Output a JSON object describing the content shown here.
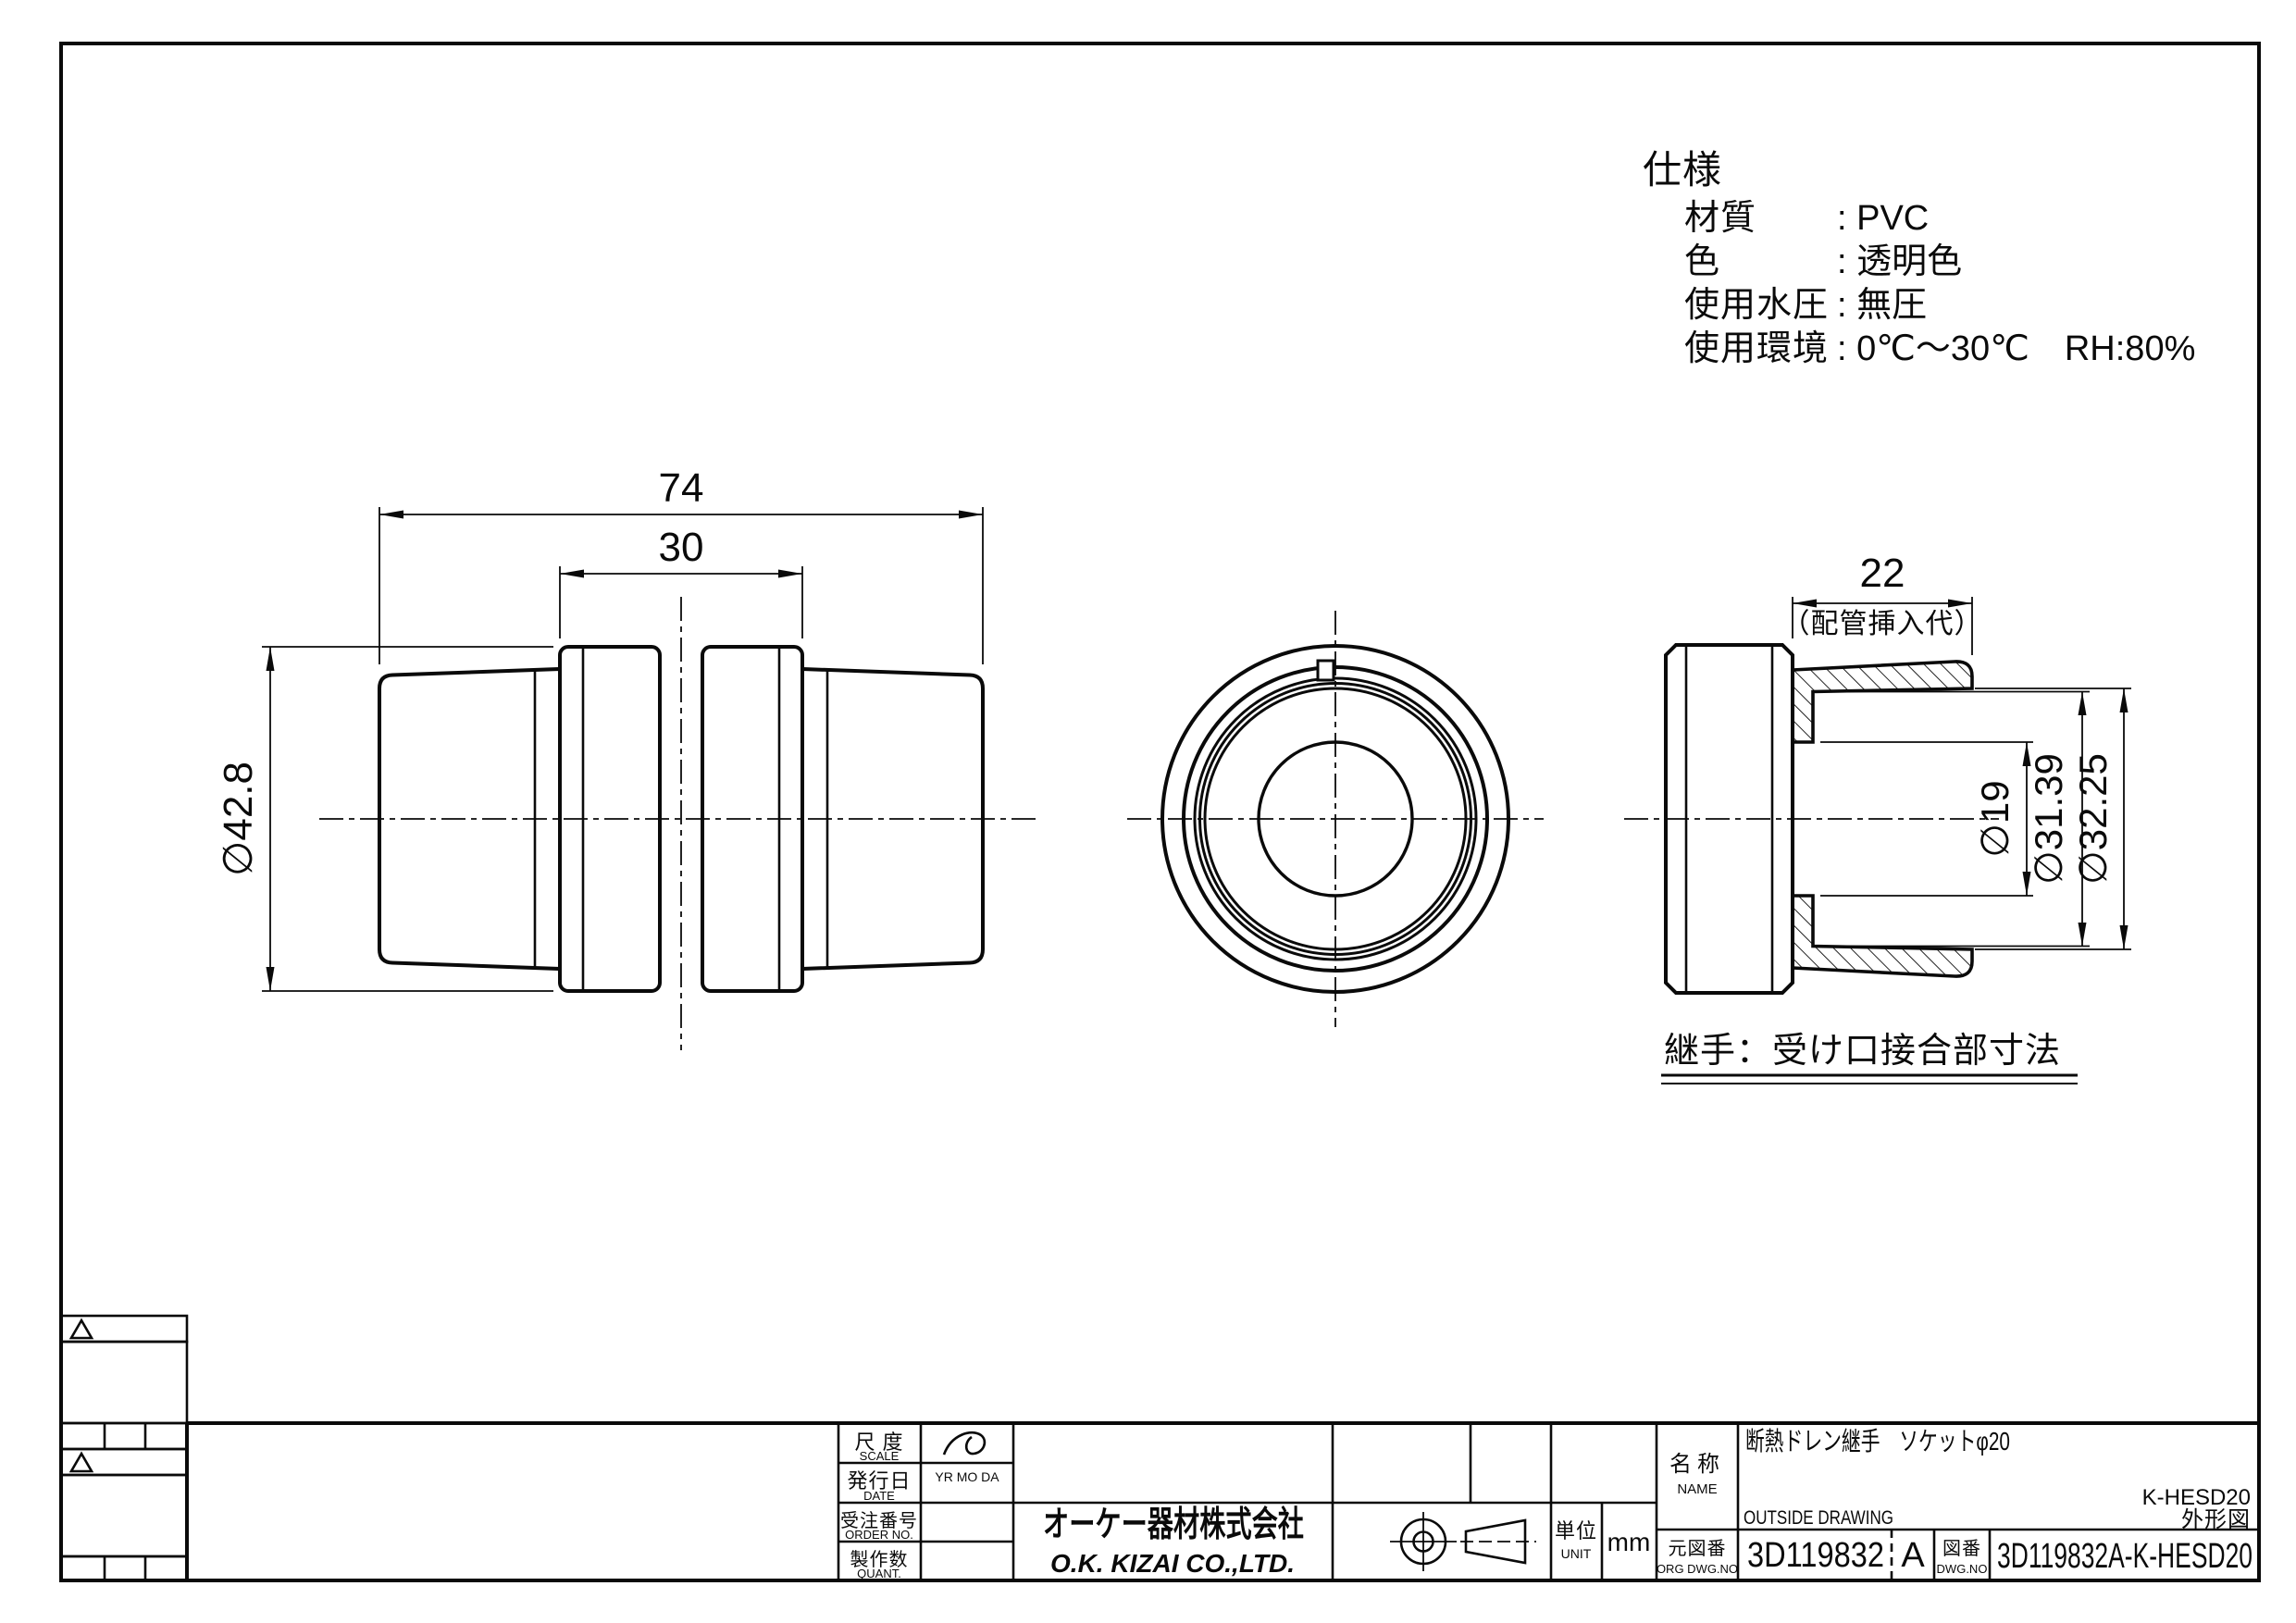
{
  "spec": {
    "title": "仕様",
    "rows": [
      {
        "label": "材質",
        "value": ": PVC"
      },
      {
        "label": "色",
        "value": ": 透明色"
      },
      {
        "label": "使用水圧",
        "value": ": 無圧"
      },
      {
        "label": "使用環境",
        "value": ": 0℃～30℃　RH:80%"
      }
    ]
  },
  "front_view": {
    "dim_overall": "74",
    "dim_hub_width": "30",
    "dim_outer_dia": "∅42.8"
  },
  "section_view": {
    "dim_insertion": "22",
    "dim_insertion_note": "（配管挿入代）",
    "dim_bore": "∅19",
    "dim_socket_back": "∅31.39",
    "dim_socket_mouth": "∅32.25",
    "caption": "継手：受け口接合部寸法"
  },
  "title_block": {
    "scale_label_jp": "尺 度",
    "scale_label_en": "SCALE",
    "date_label_jp": "発行日",
    "date_label_en": "DATE",
    "date_columns": "YR  MO  DA",
    "order_label_jp": "受注番号",
    "order_label_en": "ORDER NO.",
    "qty_label_jp": "製作数",
    "qty_label_en": "QUANT.",
    "company_jp": "オーケー器材株式会社",
    "company_en": "O.K. KIZAI CO.,LTD.",
    "unit_label_jp": "単位",
    "unit_label_en": "UNIT",
    "unit_value": "mm",
    "name_label_jp": "名称",
    "name_label_en": "NAME",
    "name_value": "断熱ドレン継手　ソケットφ20",
    "drawing_type": "OUTSIDE DRAWING",
    "model_code": "K-HESD20",
    "drawing_kind_jp": "外形図",
    "org_dwg_label_jp": "元図番",
    "org_dwg_label_en": "ORG DWG.NO",
    "org_dwg_no": "3D119832",
    "revision": "A",
    "dwg_label_jp": "図番",
    "dwg_label_en": "DWG.NO",
    "dwg_no": "3D119832A-K-HESD20"
  }
}
